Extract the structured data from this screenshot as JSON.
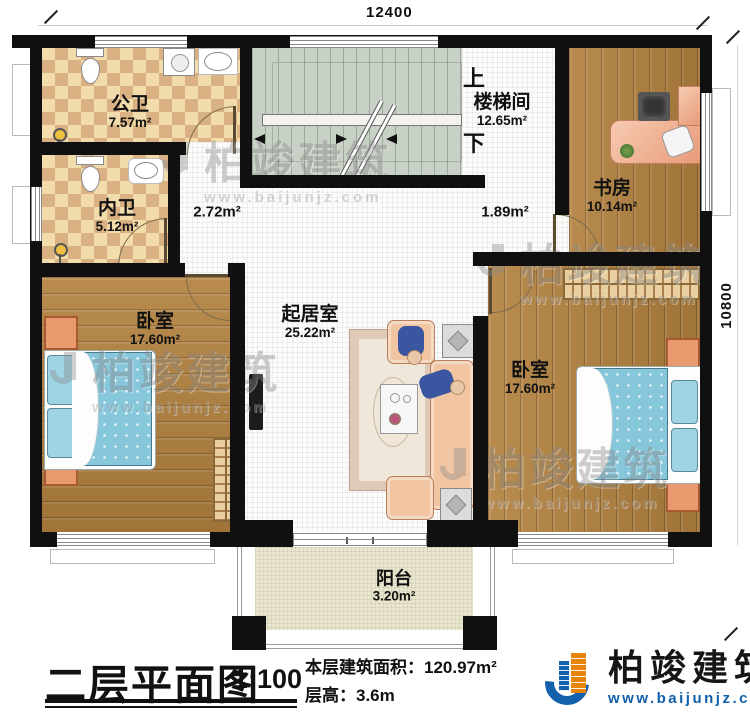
{
  "dimensions": {
    "top_width": "12400",
    "right_height": "10800"
  },
  "rooms": [
    {
      "name": "公卫",
      "area": "7.57m²"
    },
    {
      "name": "内卫",
      "area": "5.12m²"
    },
    {
      "name": "楼梯间",
      "area": "12.65m²"
    },
    {
      "name": "书房",
      "area": "10.14m²"
    },
    {
      "name": "卧室",
      "area": "17.60m²"
    },
    {
      "name": "起居室",
      "area": "25.22m²"
    },
    {
      "name": "卧室",
      "area": "17.60m²"
    },
    {
      "name": "阳台",
      "area": "3.20m²"
    }
  ],
  "corridors": {
    "left_area": "2.72m²",
    "right_area": "1.89m²"
  },
  "stairs": {
    "up_label": "上",
    "down_label": "下"
  },
  "title_block": {
    "plan_title": "二层平面图",
    "scale": "1:100",
    "floor_area": "本层建筑面积：120.97m²",
    "floor_height": "层高：3.6m"
  },
  "brand": {
    "name": "柏竣建筑",
    "website": "www.baijunjz.com"
  },
  "watermark": {
    "name": "柏竣建筑",
    "website": "www.baijunjz.com"
  },
  "colors": {
    "wall": "#101010",
    "bath_tile_light": "#f2dcab",
    "bath_tile_dark": "#d9b183",
    "wood": "#b2813f",
    "stair": "#c8d1c5",
    "balcony": "#eae5cd",
    "brand_blue": "#1462ae",
    "brand_orange": "#e8830c"
  }
}
